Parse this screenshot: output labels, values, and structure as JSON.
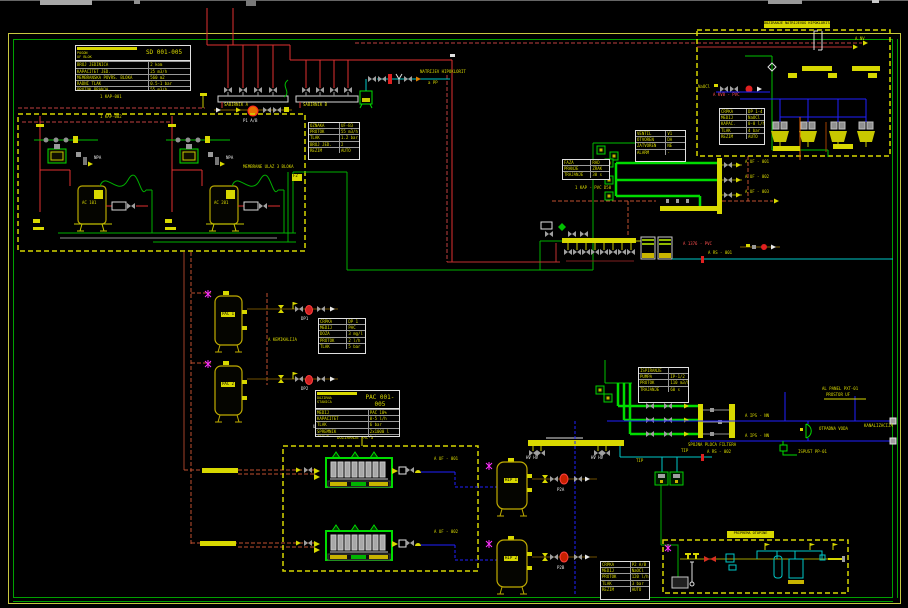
{
  "colors": {
    "background": "#000000",
    "line_yellow": "#D8D800",
    "line_green": "#00C000",
    "pipe_green": "#00DC00",
    "line_red": "#E03030",
    "line_maroon": "#C05030",
    "line_blue": "#2020FF",
    "line_cyan": "#00C8C8",
    "magenta": "#FF30FF",
    "white": "#E8E8E8",
    "gray": "#999999",
    "frame_green": "#00A000"
  },
  "labels": {
    "kap1": "1 KAP-001",
    "kap2": "1 KAP-002",
    "ac1": "AC 101",
    "ac2": "AC 201",
    "npa1": "NPA",
    "npa2": "NPA",
    "membrane": "MEMBRANE ULAZ 3 BLOKA",
    "f2": "F2",
    "sp1": "SABIRNIK A",
    "sp2": "SABIRNIK B",
    "p1": "P1 A/B",
    "natrijev": "NATRIJEV HIPOKLORIT",
    "app": "a PP",
    "anv": "A NV",
    "tr_title": "DOZIRANJE NATRIJEVOG HIPOKLORITA",
    "naocl2": "NaOCl",
    "kv8": "A KV8 - PVC",
    "a1376": "A 1376 - PVC",
    "ars001": "A RS - 001",
    "akap": "1 KAP - PVC D50",
    "alk1": "A UF - 001",
    "alk2": "A UF - 002",
    "alk3": "A UF - 003",
    "ips1": "A IPS - NN",
    "ips2": "A IPS - NN",
    "spojna": "SPOJNA PLOCA FILTERA",
    "otpad": "OTPADNA VODA",
    "kanal": "KANALIZACIJA",
    "alarm": "AL PANEL PXT-01",
    "prostor": "PROSTOR UF",
    "ispust": "ISPUST PP-01",
    "tip1": "TIP",
    "tip2": "TIP",
    "ars002": "A RS - 002",
    "uf001": "A UF - 001",
    "uf002": "A UF - 002",
    "hv1": "HV  HV",
    "hv2": "HV  HV",
    "p2a": "P2A",
    "p2b": "P2B",
    "dp1": "DP1",
    "dp2": "DP2",
    "bc_title": "ULTRAFILTRACIJA - BLOK 3",
    "doziranje": "DOZIRANJE PAC-a",
    "kem": "A KEMIKALIJA",
    "br_title": "PRIPREMA OTOPINE",
    "pac1tag": "PAC 1",
    "pac2tag": "PAC 2",
    "hip1tag": "HIP 1",
    "hip2tag": "HIP 2"
  },
  "tables": {
    "sd": {
      "h1": "POGON",
      "h2": "UF BLOK",
      "title": "SD 001-005",
      "rows": [
        {
          "l": "BROJ JEDINICA",
          "v": "2 kom"
        },
        {
          "l": "KAPACITET JED.",
          "v": "25 m3/h"
        },
        {
          "l": "MEMBRANSKA POVRS. BLOKA",
          "v": "560 m2"
        },
        {
          "l": "RADNI TLAK",
          "v": "0.5-1 bar"
        },
        {
          "l": "PROTOK PRANJA",
          "v": "55 m3/h"
        },
        {
          "l": "TEMP. VODE",
          "v": "5-25 C"
        }
      ]
    },
    "a": {
      "rows": [
        {
          "l": "OZNAKA",
          "v": "UF-B3"
        },
        {
          "l": "PROTOK",
          "v": "55 m3/h"
        },
        {
          "l": "TLAK",
          "v": "1.2 bar"
        },
        {
          "l": "BROJ JED.",
          "v": "2"
        },
        {
          "l": "REZIM",
          "v": "AUTO"
        }
      ]
    },
    "b": {
      "rows": [
        {
          "l": "VENTIL",
          "v": "V1"
        },
        {
          "l": "OTVOREN",
          "v": "DA"
        },
        {
          "l": "ZATVOREN",
          "v": "NE"
        },
        {
          "l": "ALARM",
          "v": "-"
        }
      ]
    },
    "c": {
      "rows": [
        {
          "l": "FAZA",
          "v": "RAD"
        },
        {
          "l": "PRANJE",
          "v": "ZRAK"
        },
        {
          "l": "TRAJANJE",
          "v": "30 s"
        }
      ]
    },
    "d": {
      "rows": [
        {
          "l": "ISPIRANJE",
          "v": ""
        },
        {
          "l": "PUMPA",
          "v": "IP-1/2"
        },
        {
          "l": "PROTOK",
          "v": "110 m3/h"
        },
        {
          "l": "TRAJANJE",
          "v": "60 s"
        }
      ]
    },
    "pac_small": {
      "rows": [
        {
          "l": "CRPKA",
          "v": "DP 1"
        },
        {
          "l": "MEDIJ",
          "v": "PAC"
        },
        {
          "l": "DOZA",
          "v": "3 mg/l"
        },
        {
          "l": "PROTOK",
          "v": "2 l/h"
        },
        {
          "l": "TLAK",
          "v": "5 bar"
        }
      ]
    },
    "pac": {
      "h1": "DOZIRNA",
      "h2": "STANICA",
      "title": "PAC 001-005",
      "rows": [
        {
          "l": "MEDIJ",
          "v": "PAC 10%"
        },
        {
          "l": "KAPACITET",
          "v": "0-5 l/h"
        },
        {
          "l": "TLAK",
          "v": "6 bar"
        },
        {
          "l": "SPREMNIK",
          "v": "2x1000 l"
        },
        {
          "l": "CRPKE",
          "v": "2 kom"
        }
      ]
    },
    "tr": {
      "rows": [
        {
          "l": "CRPKA",
          "v": "DP 1-4"
        },
        {
          "l": "MEDIJ",
          "v": "NaOCl"
        },
        {
          "l": "KAPAC.",
          "v": "0-8 l/h"
        },
        {
          "l": "TLAK",
          "v": "4 bar"
        },
        {
          "l": "REZIM",
          "v": "AUTO"
        }
      ]
    },
    "bc": {
      "rows": [
        {
          "l": "CRPKA",
          "v": "P2 A/B"
        },
        {
          "l": "MEDIJ",
          "v": "NaOCl"
        },
        {
          "l": "PROTOK",
          "v": "120 l/h"
        },
        {
          "l": "TLAK",
          "v": "3 bar"
        },
        {
          "l": "REZIM",
          "v": "AUTO"
        }
      ]
    }
  }
}
